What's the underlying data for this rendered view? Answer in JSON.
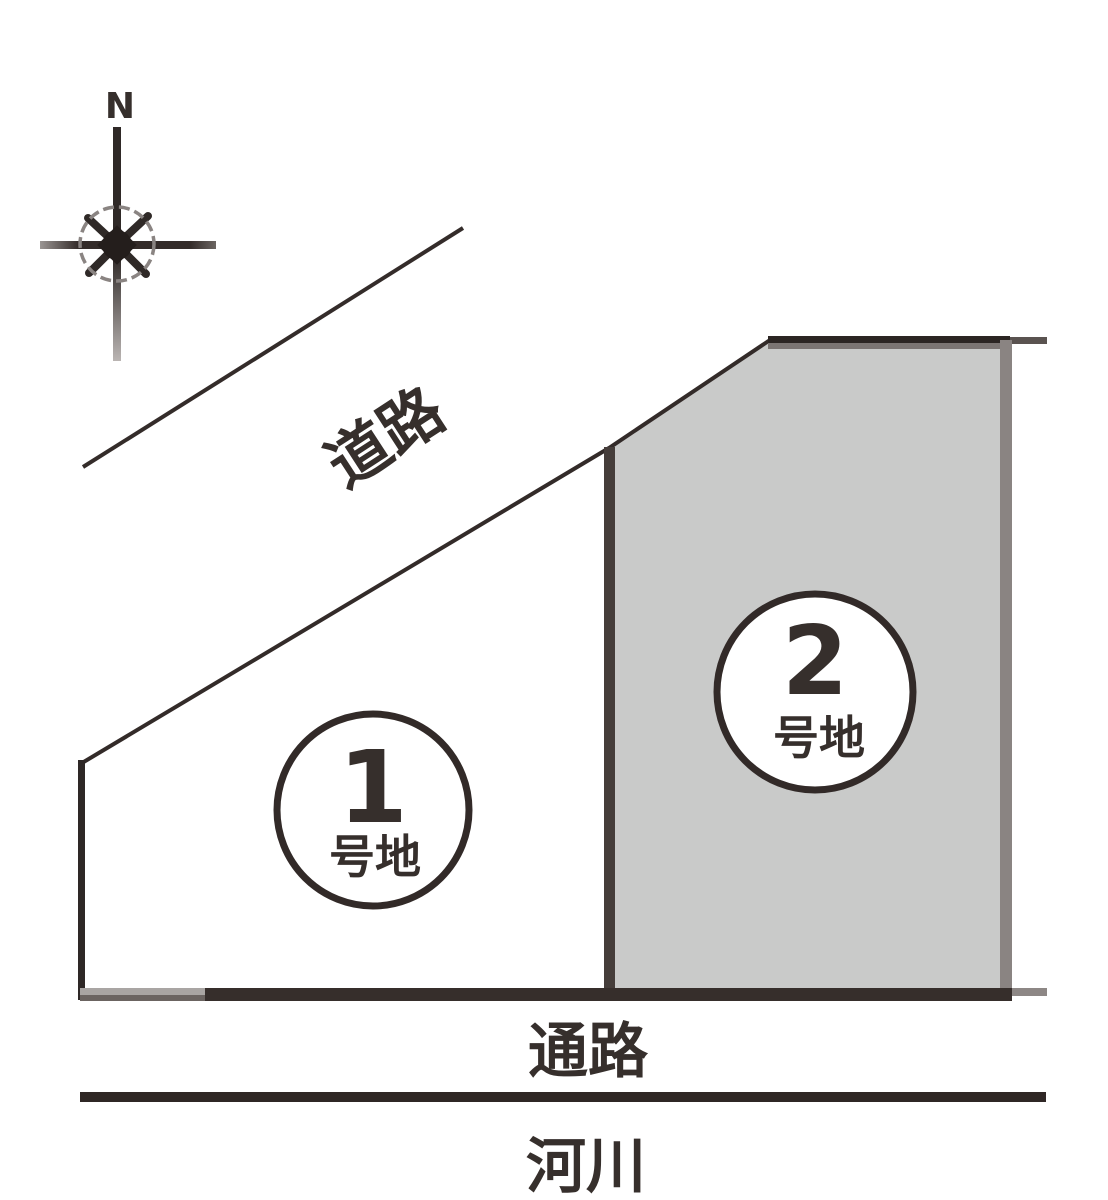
{
  "diagram": {
    "compass": {
      "label": "N"
    },
    "road": {
      "label": "道路"
    },
    "passage": {
      "label": "通路"
    },
    "river": {
      "label": "河川"
    },
    "lots": [
      {
        "number": "1",
        "suffix": "号地",
        "fill": "#ffffff"
      },
      {
        "number": "2",
        "suffix": "号地",
        "fill": "#c9cac9"
      }
    ],
    "colors": {
      "line_dark": "#2e2724",
      "line_medium": "#5a5350",
      "border_gray": "#8a8482",
      "lot2_fill": "#c9cac9",
      "text": "#362f2c",
      "background": "#ffffff"
    }
  }
}
